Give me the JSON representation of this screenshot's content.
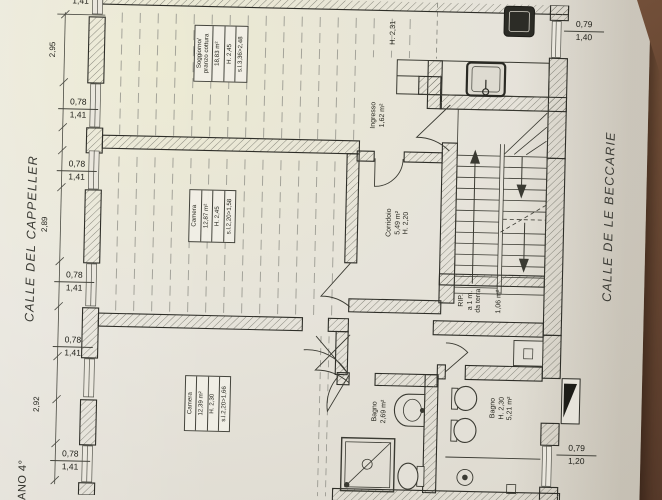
{
  "colors": {
    "paper": "#e6e3da",
    "wood_table": "#74513a",
    "ink": "#2e2e28"
  },
  "streets": {
    "left": "CALLE DEL CAPPELLER",
    "right": "CALLE DE LE BECCARIE"
  },
  "floor_label": "PIANO 4°",
  "rooms": {
    "soggiorno": {
      "name1": "Soggiorno/",
      "name2": "pranzo cottura",
      "area": "18,83 m²",
      "height": "H. 2,45",
      "sl": "s.l.3,36>2,48"
    },
    "camera_mid": {
      "name": "Camera",
      "area": "12,87 m²",
      "height": "H. 2,45",
      "sl": "s.l.2,20>1,58"
    },
    "camera_bottom": {
      "name": "Camera",
      "area": "12,39 m²",
      "height": "H. 2,30",
      "sl": "s.l.2,20>1,66"
    },
    "corridoio": {
      "name": "Corridoio",
      "area": "5,49 m²",
      "height": "H. 2,20"
    },
    "ingresso": {
      "name": "Ingresso",
      "area": "1,62 m²"
    },
    "bagno_small": {
      "name": "Bagno",
      "area": "2,69 m²"
    },
    "bagno_large": {
      "name": "Bagno",
      "height": "H. 2,30",
      "area": "5,21 m²"
    },
    "rip": {
      "line1": "RIP.",
      "line2": "a 1 m.",
      "line3": "da terra",
      "area": "1,06 m²"
    }
  },
  "annotations": {
    "stair_height": "H. 2,31"
  },
  "dimensions": {
    "left_chain": [
      {
        "width": "1,41"
      },
      {
        "span": "2,95"
      },
      {
        "height": "0,78",
        "width": "1,41"
      },
      {
        "height": "0,78",
        "width": "1,41"
      },
      {
        "span": "2,89"
      },
      {
        "height": "0,78",
        "width": "1,41"
      },
      {
        "height": "0,78",
        "width": "1,41"
      },
      {
        "span": "2,92"
      },
      {
        "height": "0,78",
        "width": "1,41"
      }
    ],
    "top_right": {
      "height": "0,79",
      "width": "1,40"
    },
    "bottom_right": {
      "height": "0,79",
      "width": "1,20"
    }
  }
}
